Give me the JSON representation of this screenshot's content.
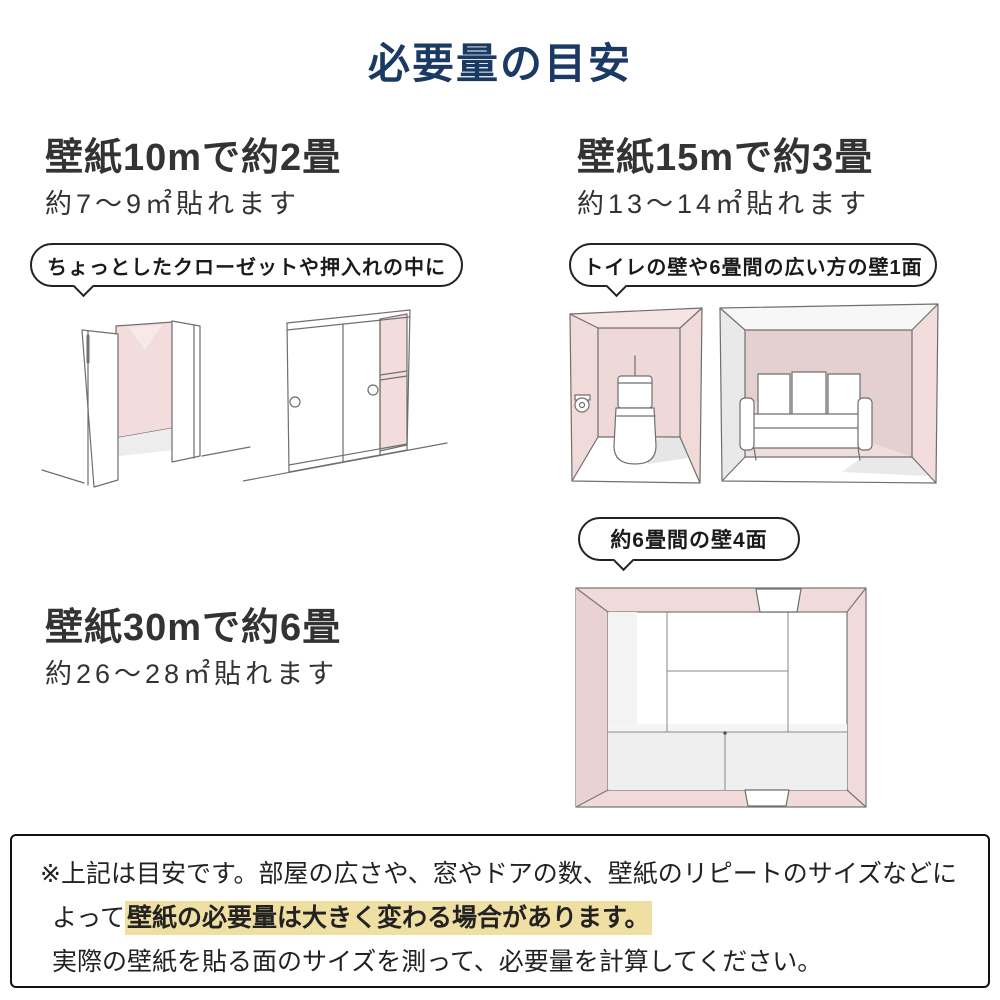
{
  "title": "必要量の目安",
  "sections": {
    "s10": {
      "heading": "壁紙10mで約2畳",
      "subtext": "約7〜9㎡貼れます",
      "bubble": "ちょっとしたクローゼットや押入れの中に"
    },
    "s15": {
      "heading": "壁紙15mで約3畳",
      "subtext": "約13〜14㎡貼れます",
      "bubble": "トイレの壁や6畳間の広い方の壁1面"
    },
    "s30": {
      "heading": "壁紙30mで約6畳",
      "subtext": "約26〜28㎡貼れます",
      "bubble": "約6畳間の壁4面"
    }
  },
  "note": {
    "line1": "※上記は目安です。部屋の広さや、窓やドアの数、壁紙のリピートのサイズなどに",
    "line2_prefix": "よって",
    "line2_highlight": "壁紙の必要量は大きく変わる場合があります。",
    "line3": "実際の壁紙を貼る面のサイズを測って、必要量を計算してください。"
  },
  "colors": {
    "title_navy": "#1a3a64",
    "heading_gray": "#333333",
    "wall_pink": "#f2dcdc",
    "wall_pink_dark": "#e4d0d0",
    "highlight_yellow": "#f0dfa2",
    "sketch_line": "#6f6f6f"
  }
}
